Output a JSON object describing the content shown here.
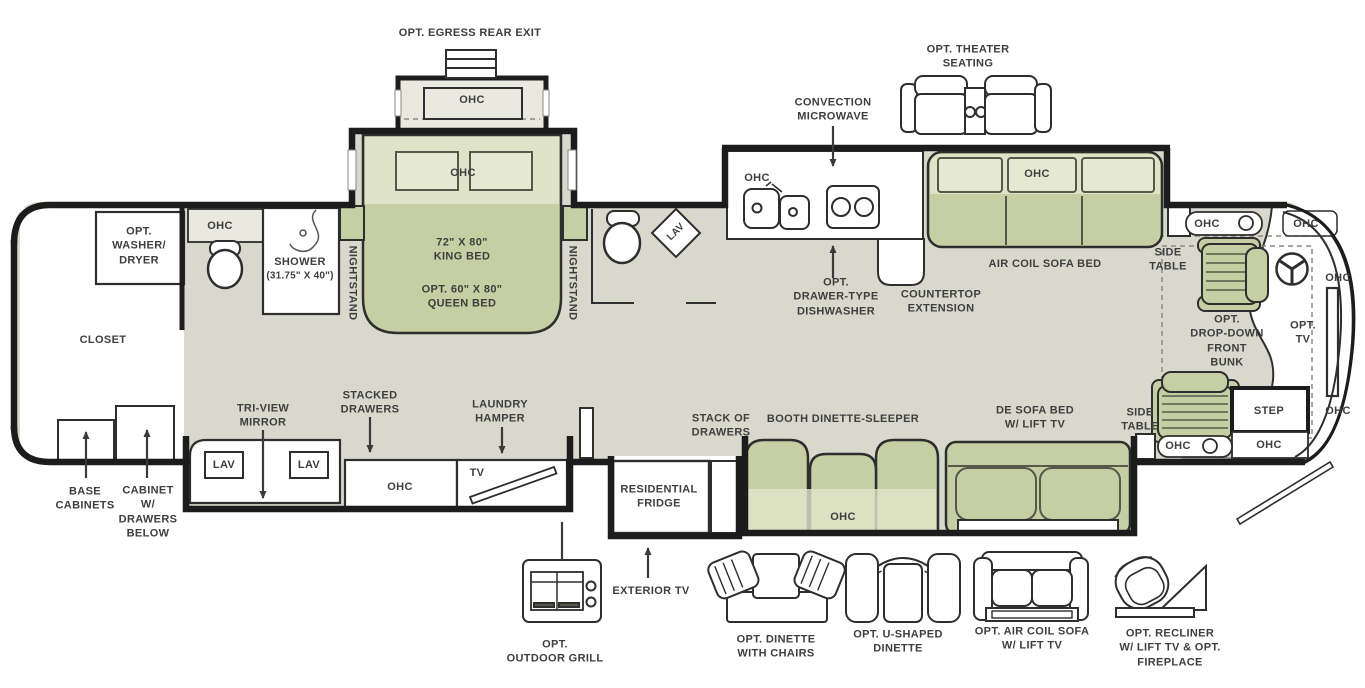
{
  "colors": {
    "wall": "#1c1c1c",
    "floor": "#d9d8cc",
    "furniture_green": "#c6cfa3",
    "furniture_green_light": "#dfe3c8",
    "panel_light": "#e9e9df",
    "white": "#ffffff",
    "text": "#3e3e3e"
  },
  "labels": {
    "egress": "OPT. EGRESS REAR EXIT",
    "theater": "OPT. THEATER\nSEATING",
    "microwave": "CONVECTION\nMICROWAVE",
    "ohc": "OHC",
    "washer_dryer": "OPT.\nWASHER/\nDRYER",
    "shower_title": "SHOWER",
    "shower_size": "(31.75\" X 40\")",
    "nightstand": "NIGHTSTAND",
    "king_bed": "72\" X 80\"\nKING BED",
    "queen_bed": "OPT. 60\" X 80\"\nQUEEN BED",
    "closet": "CLOSET",
    "dishwasher": "OPT.\nDRAWER-TYPE\nDISHWASHER",
    "countertop": "COUNTERTOP\nEXTENSION",
    "air_coil_sofa_bed": "AIR COIL SOFA BED",
    "side_table": "SIDE\nTABLE",
    "front_bunk": "OPT.\nDROP-DOWN\nFRONT\nBUNK",
    "opt_tv": "OPT.\nTV",
    "step": "STEP",
    "tri_view_mirror": "TRI-VIEW\nMIRROR",
    "stacked_drawers": "STACKED\nDRAWERS",
    "laundry_hamper": "LAUNDRY\nHAMPER",
    "lav": "LAV",
    "tv": "TV",
    "base_cabinets": "BASE\nCABINETS",
    "cabinet_drawers": "CABINET\nW/\nDRAWERS\nBELOW",
    "stack_of_drawers": "STACK OF\nDRAWERS",
    "booth_dinette": "BOOTH DINETTE-SLEEPER",
    "de_sofa": "DE SOFA BED\nW/ LIFT TV",
    "fridge": "RESIDENTIAL\nFRIDGE",
    "exterior_tv": "EXTERIOR TV",
    "outdoor_grill": "OPT.\nOUTDOOR GRILL",
    "dinette_chairs": "OPT. DINETTE\nWITH CHAIRS",
    "u_dinette": "OPT. U-SHAPED\nDINETTE",
    "air_coil_sofa_opt": "OPT. AIR COIL SOFA\nW/ LIFT TV",
    "recliner_opt": "OPT. RECLINER\nW/ LIFT TV & OPT.\nFIREPLACE"
  }
}
